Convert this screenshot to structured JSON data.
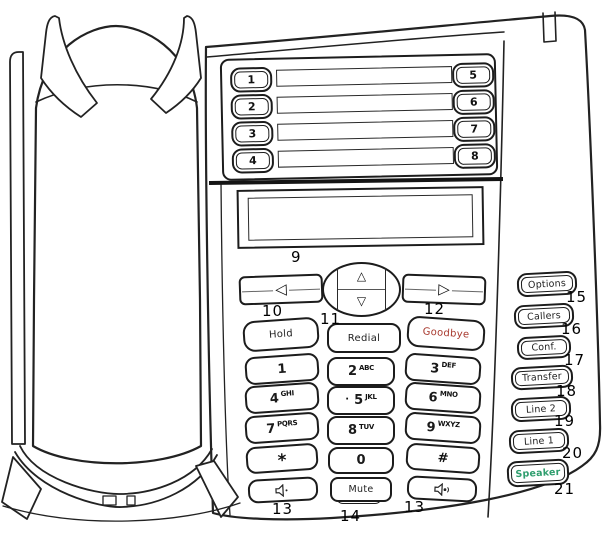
{
  "colors": {
    "ink": "#1c1c1c",
    "goodbye_text": "#a8392e",
    "speaker_text": "#2f9e6e"
  },
  "programmable_keys": {
    "rows": [
      {
        "left": "1",
        "right": "5"
      },
      {
        "left": "2",
        "right": "6"
      },
      {
        "left": "3",
        "right": "7"
      },
      {
        "left": "4",
        "right": "8"
      }
    ]
  },
  "callouts": {
    "display": "9",
    "nav_left": "10",
    "nav_center": "11",
    "nav_right": "12",
    "volume_left": "13",
    "mute": "14",
    "volume_right": "13",
    "options": "15",
    "callers": "16",
    "conf": "17",
    "transfer": "18",
    "line2": "19",
    "line1": "20",
    "speaker": "21"
  },
  "nav": {
    "left_glyph": "◁",
    "right_glyph": "▷",
    "up_glyph": "△",
    "down_glyph": "▽"
  },
  "feature_keys": {
    "hold": "Hold",
    "redial": "Redial",
    "goodbye": "Goodbye",
    "mute": "Mute"
  },
  "dialpad": [
    {
      "digit": "1",
      "letters": ""
    },
    {
      "digit": "2",
      "letters": "ABC"
    },
    {
      "digit": "3",
      "letters": "DEF"
    },
    {
      "digit": "4",
      "letters": "GHI"
    },
    {
      "digit": "5",
      "letters": "JKL",
      "dot": "·"
    },
    {
      "digit": "6",
      "letters": "MNO"
    },
    {
      "digit": "7",
      "letters": "PQRS"
    },
    {
      "digit": "8",
      "letters": "TUV"
    },
    {
      "digit": "9",
      "letters": "WXYZ"
    },
    {
      "digit": "*",
      "letters": ""
    },
    {
      "digit": "0",
      "letters": ""
    },
    {
      "digit": "#",
      "letters": ""
    }
  ],
  "side_keys": [
    {
      "label": "Options"
    },
    {
      "label": "Callers"
    },
    {
      "label": "Conf."
    },
    {
      "label": "Transfer"
    },
    {
      "label": "Line 2"
    },
    {
      "label": "Line 1"
    },
    {
      "label": "Speaker"
    }
  ]
}
